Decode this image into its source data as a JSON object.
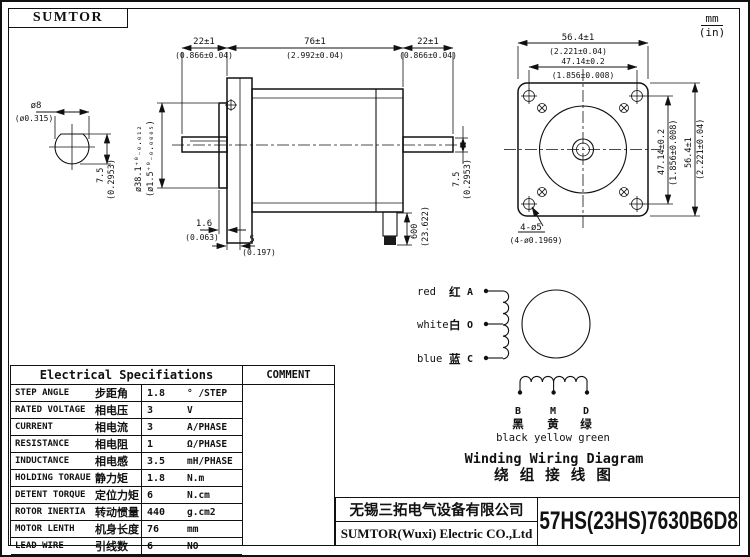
{
  "meta": {
    "brand": "SUMTOR",
    "units_mm": "mm",
    "units_in": "(in)"
  },
  "side_view": {
    "top_left_mm": "22±1",
    "top_left_in": "(0.866±0.04)",
    "top_mid_mm": "76±1",
    "top_mid_in": "(2.992±0.04)",
    "top_right_mm": "22±1",
    "top_right_in": "(0.866±0.04)",
    "shaft_dia_mm": "ø8",
    "shaft_dia_in": "(ø0.315)",
    "shaft_flat_mm": "7.5",
    "shaft_flat_in": "(0.2953)",
    "pilot_mm": "ø38.1⁺⁰₋₀.₀₁₂",
    "pilot_in": "(ø1.5⁺⁰₋₀.₀₀₀₅)",
    "boss_mm": "1.6",
    "boss_in": "(0.063)",
    "step_mm": "5",
    "step_in": "(0.197)",
    "cable_mm": "600",
    "cable_in": "(23.622)",
    "rear_flat_mm": "7.5",
    "rear_flat_in": "(0.2953)"
  },
  "front_view": {
    "width_mm": "56.4±1",
    "width_in": "(2.221±0.04)",
    "holes_mm": "47.14±0.2",
    "holes_in": "(1.856±0.008)",
    "holes_v_mm": "47.14±0.2",
    "holes_v_in": "(1.856±0.008)",
    "height_mm": "56.4±1",
    "height_in": "(2.221±0.04)",
    "holes_label": "4-ø5",
    "holes_label_in": "(4-ø0.1969)"
  },
  "wiring": {
    "lead_a_en": "red",
    "lead_a_cn": "红",
    "lead_a_id": "A",
    "lead_o_en": "white",
    "lead_o_cn": "白",
    "lead_o_id": "O",
    "lead_c_en": "blue",
    "lead_c_cn": "蓝",
    "lead_c_id": "C",
    "term_b": "B",
    "term_m": "M",
    "term_d": "D",
    "term_b_cn": "黑",
    "term_m_cn": "黄",
    "term_d_cn": "绿",
    "term_colors_en": "black yellow green",
    "title_en": "Winding Wiring Diagram",
    "title_cn": "绕 组 接 线 图"
  },
  "spec_table": {
    "header": "Electrical Specifiations",
    "comment_header": "COMMENT",
    "rows": [
      {
        "en": "STEP ANGLE",
        "cn": "步距角",
        "value": "1.8",
        "unit": "° /STEP"
      },
      {
        "en": "RATED VOLTAGE",
        "cn": "相电压",
        "value": "3",
        "unit": "V"
      },
      {
        "en": "CURRENT",
        "cn": "相电流",
        "value": "3",
        "unit": "A/PHASE"
      },
      {
        "en": "RESISTANCE",
        "cn": "相电阻",
        "value": "1",
        "unit": "Ω/PHASE"
      },
      {
        "en": "INDUCTANCE",
        "cn": "相电感",
        "value": "3.5",
        "unit": "mH/PHASE"
      },
      {
        "en": "HOLDING TORAUE",
        "cn": "静力矩",
        "value": "1.8",
        "unit": "N.m"
      },
      {
        "en": "DETENT TORQUE",
        "cn": "定位力矩",
        "value": "6",
        "unit": "N.cm"
      },
      {
        "en": "ROTOR INERTIA",
        "cn": "转动惯量",
        "value": "440",
        "unit": "g.cm2"
      },
      {
        "en": "MOTOR LENTH",
        "cn": "机身长度",
        "value": "76",
        "unit": "mm"
      },
      {
        "en": "LEAD WIRE",
        "cn": "引线数",
        "value": "6",
        "unit": "NO"
      },
      {
        "en": "MOTOR WEIGHT",
        "cn": "重量",
        "value": "1050",
        "unit": "g"
      }
    ]
  },
  "title_block": {
    "company_cn": "无锡三拓电气设备有限公司",
    "company_en": "SUMTOR(Wuxi) Electric CO.,Ltd",
    "part_number": "57HS(23HS)7630B6D8"
  },
  "colors": {
    "ink": "#111111",
    "paper": "#ffffff"
  }
}
